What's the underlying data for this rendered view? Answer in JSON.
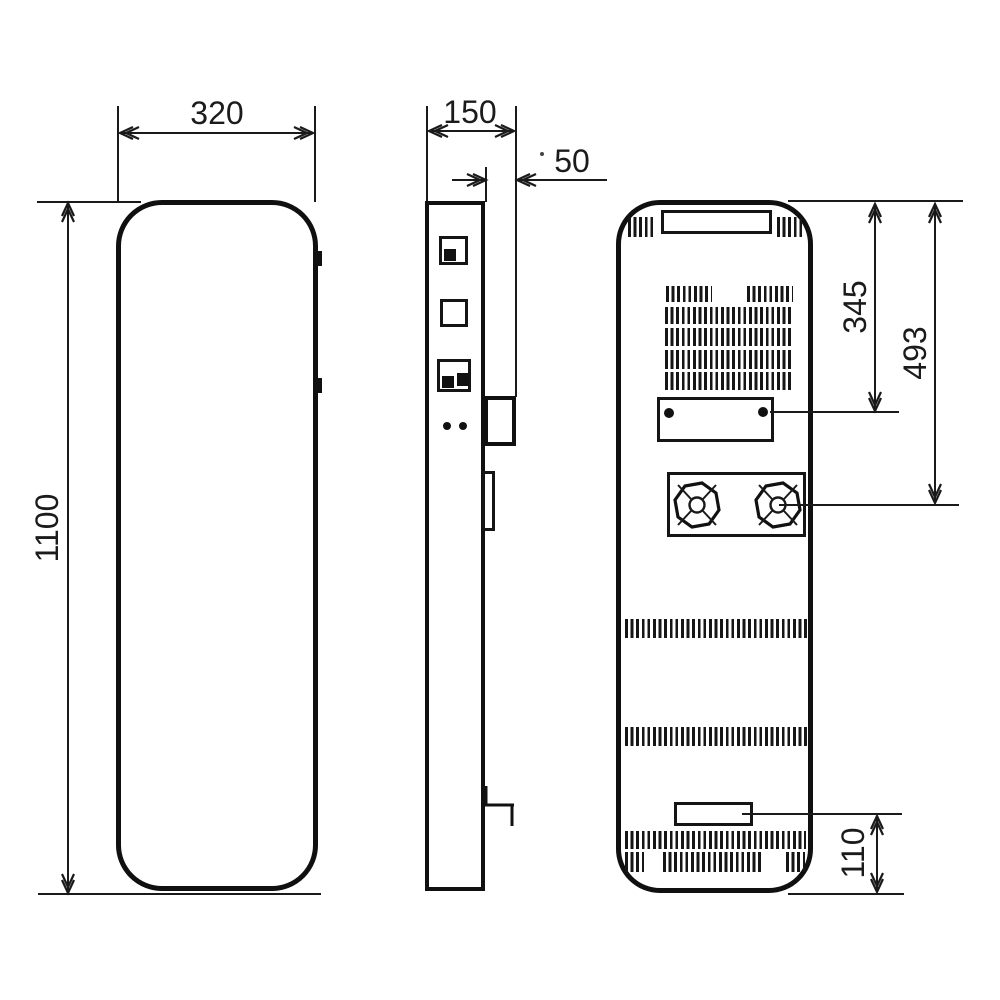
{
  "drawing": {
    "kind": "orthographic technical drawing, three views (front, side, back) of a tall wall-mounted unit",
    "views": [
      "front",
      "side",
      "back"
    ]
  },
  "dimensions": {
    "width": "320",
    "depth": "150",
    "bracket_depth": "50",
    "height": "1100",
    "plate_offset_from_top": "345",
    "fan_offset_from_top": "493",
    "outlet_offset_from_bottom": "110"
  },
  "colors": {
    "ink": "#1a1a1a",
    "paper": "#ffffff"
  },
  "icons": {
    "fan": "fan-symbol",
    "screw": "screw-hole-dot"
  }
}
